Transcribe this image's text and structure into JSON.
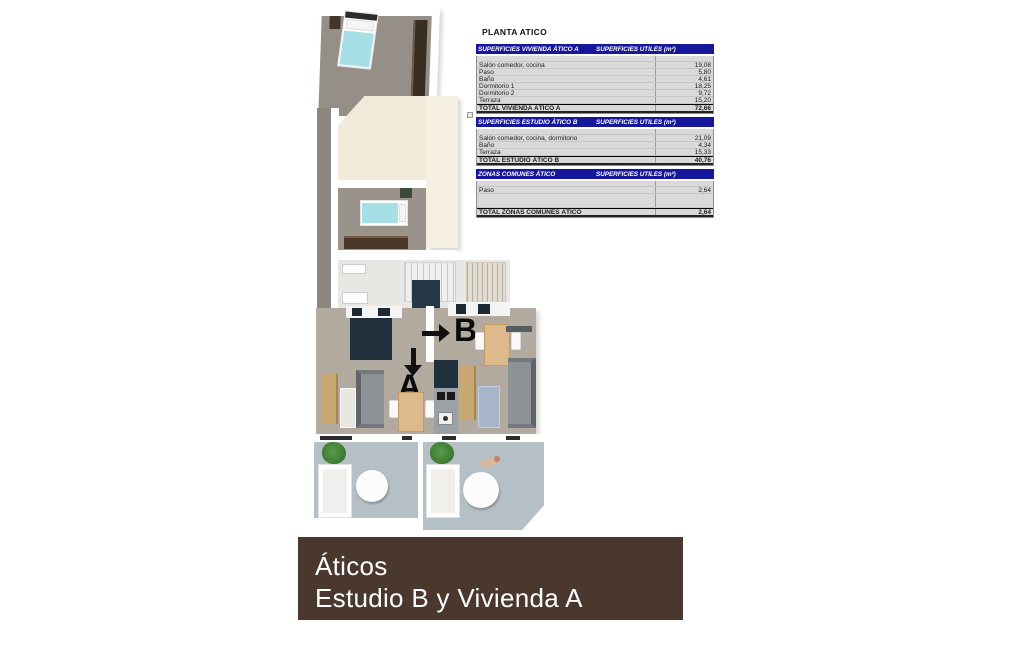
{
  "document": {
    "section_title": "PLANTA ATICO"
  },
  "tables": [
    {
      "header_left": "SUPERFICIES VIVIENDA ÁTICO A",
      "header_right": "SUPERFICIES UTILES  (m²)",
      "rows": [
        {
          "label": "Salón comedor, cocina",
          "value": "19,08"
        },
        {
          "label": "Paso",
          "value": "5,80"
        },
        {
          "label": "Baño",
          "value": "4,61"
        },
        {
          "label": "Dormitorio 1",
          "value": "18,25"
        },
        {
          "label": "Dormitorio 2",
          "value": "9,72"
        },
        {
          "label": "Terraza",
          "value": "15,20"
        }
      ],
      "total": {
        "label": "TOTAL VIVIENDA ÁTICO A",
        "value": "72,66"
      }
    },
    {
      "header_left": "SUPERFICIES ESTUDIO ÁTICO B",
      "header_right": "SUPERFICIES UTILES  (m²)",
      "rows": [
        {
          "label": "Salón comedor, cocina, dormitorio",
          "value": "21,09"
        },
        {
          "label": "Baño",
          "value": "4,34"
        },
        {
          "label": "Terraza",
          "value": "15,33"
        }
      ],
      "total": {
        "label": "TOTAL ESTUDIO ÁTICO B",
        "value": "40,76"
      }
    },
    {
      "header_left": "ZONAS COMUNES ÁTICO",
      "header_right": "SUPERFICIES UTILES  (m²)",
      "rows": [
        {
          "label": "Paso",
          "value": "2,64"
        }
      ],
      "total": {
        "label": "TOTAL ZONAS COMUNES ÁTICO",
        "value": "2,64"
      }
    }
  ],
  "plan": {
    "markers": {
      "a": "A",
      "b": "B"
    }
  },
  "banner": {
    "line1": "Áticos",
    "line2": "Estudio B y Vivienda A",
    "background": "#4a382e"
  },
  "colors": {
    "table_header_navy": "#17179c",
    "table_row_gray": "#d9d9d9",
    "banner_brown": "#4a382e",
    "bed_cyan": "#a7dfe6",
    "living_floor_taupe": "#b3aa9f",
    "bedroom_floor_gray": "#968f88",
    "terrace_blue_gray": "#b5bfc6",
    "roof_cream": "#f2ead9",
    "wood_cabinet": "#c9a771",
    "kitchen_navy": "#20303d",
    "wardrobe_brown": "#3a2d21",
    "plant_green": "#3e7c34"
  }
}
